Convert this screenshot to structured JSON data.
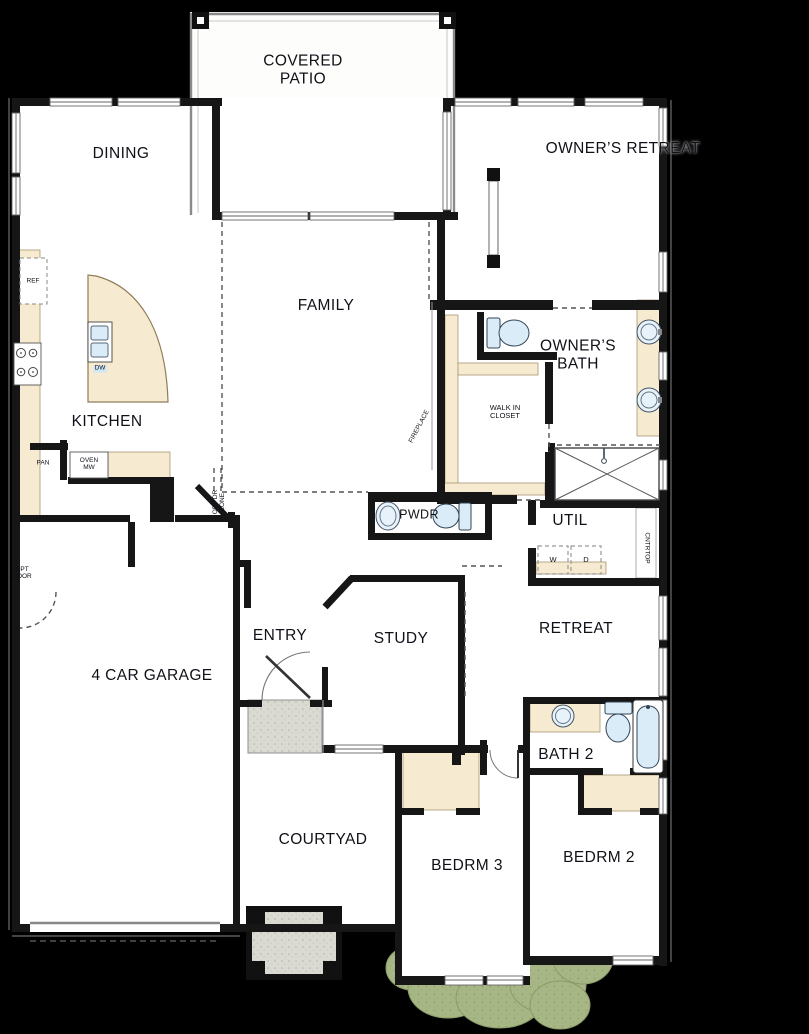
{
  "colors": {
    "background": "#000000",
    "wall": "#161616",
    "floor": "#ffffff",
    "casework": "#f6ead0",
    "fixture_blue": "#daecf8",
    "paving_gray": "#d9d9d2",
    "landscape_green": "#a7b685",
    "label_text": "#101018"
  },
  "rooms": {
    "covered_patio": "COVERED\nPATIO",
    "dining": "DINING",
    "owners_retreat": "OWNER’S RETREAT",
    "family": "FAMILY",
    "owners_bath": "OWNER’S\nBATH",
    "kitchen": "KITCHEN",
    "walk_in_closet": "WALK IN\nCLOSET",
    "pwdr": "PWDR",
    "util": "UTIL",
    "entry": "ENTRY",
    "study": "STUDY",
    "retreat": "RETREAT",
    "garage": "4 CAR GARAGE",
    "bath2": "BATH 2",
    "courtyard": "COURTYAD",
    "bedrm3": "BEDRM 3",
    "bedrm2": "BEDRM 2"
  },
  "annotations": {
    "ref": "REF",
    "pan": "PAN",
    "oven_mw": "OVEN\nMW",
    "dw": "DW",
    "washer": "W",
    "dryer": "D",
    "cntrtop": "CNTRTOP",
    "fireplace": "FIREPLACE",
    "opt_dr_zone": "OPT DR\nZONE",
    "opt_door": "OPT\nDOOR"
  }
}
